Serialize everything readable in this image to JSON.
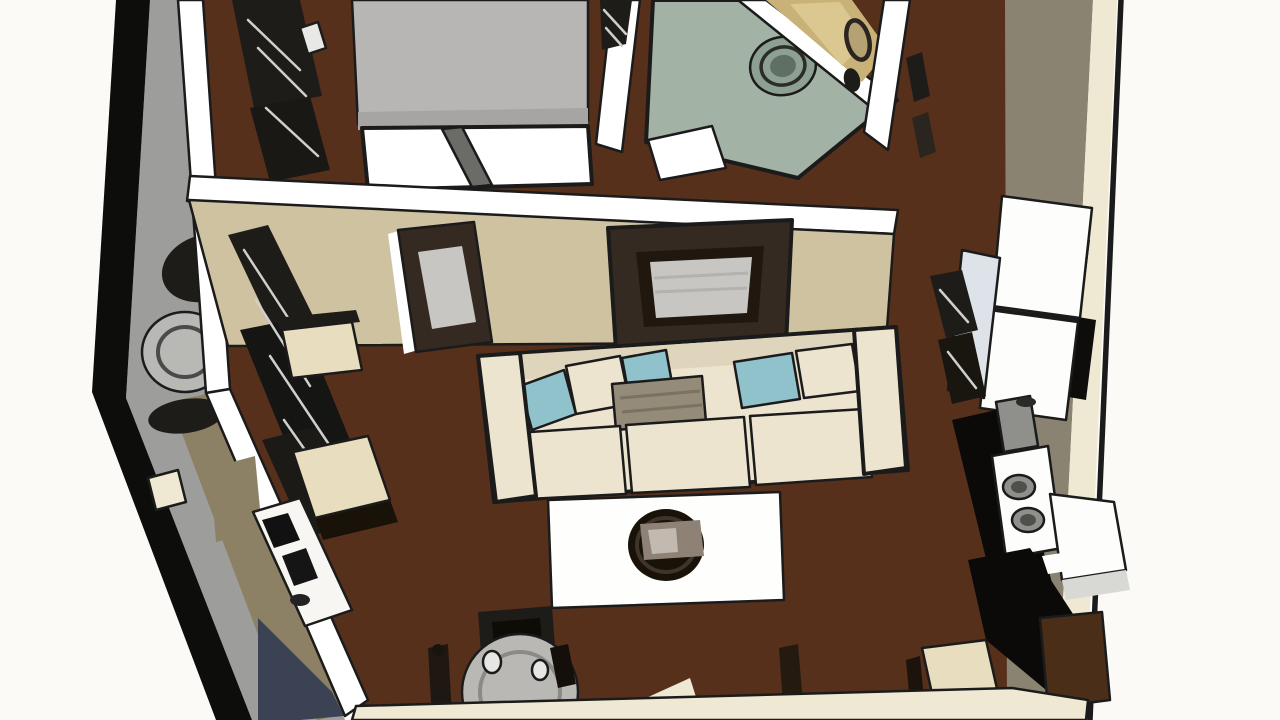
{
  "scene": {
    "kind": "sketch-style 3d floor plan rendering, isometric top-down view of a studio apartment",
    "rooms": [
      "bedroom",
      "bathroom",
      "hallway",
      "living-room",
      "kitchen",
      "dining-area",
      "balcony"
    ],
    "furniture": [
      "bed",
      "foot-bench",
      "dresser",
      "washer-vanity-with-round-basin",
      "toilet",
      "wall-mirror",
      "small-wall-frame",
      "sofa-with-teal-pillows",
      "area-rug",
      "round-coffee-table",
      "accent-chair",
      "desk-chair",
      "media-console",
      "desk-with-electronics",
      "kitchen-counter",
      "sink",
      "cooktop-two-burners",
      "refrigerator",
      "cabinet-island",
      "brown-cabinet",
      "kitchen-chair",
      "round-dining-table",
      "dining-chairs",
      "wine-glasses",
      "patio-table",
      "patio-chair"
    ]
  },
  "colors": {
    "exterior": "#fbfaf7",
    "outline": "#1b1b1b",
    "band_black": "#0d0d0c",
    "balcony_gray": "#9d9d9b",
    "patio_table_gray": "#b8b8b5",
    "wall_white": "#ffffff",
    "floor_brown": "#57301c",
    "bathroom_sage": "#a2b2a4",
    "sage_ring_mid": "#8da092",
    "sage_ring_deep": "#5f6f64",
    "tan_tile": "#c8b277",
    "tan_tile_light": "#dbc890",
    "wall_tan": "#cfc2a0",
    "frame_dark": "#342a21",
    "frame_bevel": "#20180f",
    "frame_panel": "#c7c6c3",
    "sofa_cream": "#ece4cf",
    "sofa_shade": "#ded5bc",
    "pillow_teal": "#8fc2ca",
    "pillow_gray": "#948b78",
    "rug_white": "#fefefc",
    "coffee_table_dark": "#181209",
    "tray_gray": "#8d8275",
    "tray_light": "#c2bab0",
    "chair_cream": "#e8ddbe",
    "desk_white": "#f7f6f2",
    "kitchen_white": "#fdfdfb",
    "kitchen_black": "#0b0a08",
    "sink_gray": "#8f8f8c",
    "appliance_blue": "#dde3e8",
    "cabinet_brown": "#4b2e18",
    "wall_taupe": "#8b8372",
    "wall_cream": "#efe8d3",
    "shadow_navy": "#3a4253",
    "khaki": "#8d8165",
    "slate": "#4d5868",
    "bed_gray": "#b7b6b4",
    "bed_gray_shade": "#a6a5a3",
    "sketch_dark": "#1e1c18",
    "table_gray": "#b9b8b4",
    "glass_gray": "#e6e6e3"
  }
}
